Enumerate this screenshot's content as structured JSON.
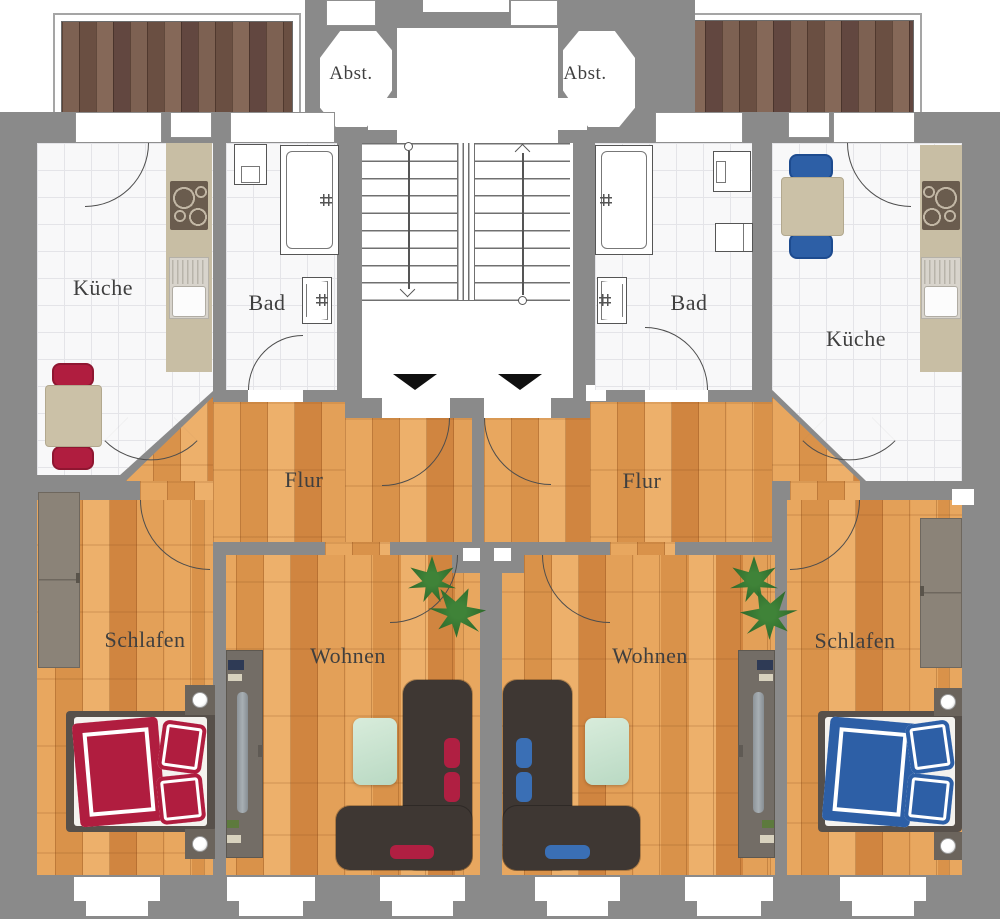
{
  "floorplan": {
    "type": "apartment-floor-plan",
    "language": "de",
    "labels": {
      "storage_left": "Abst.",
      "storage_right": "Abst.",
      "kitchen_left": "Küche",
      "bath_left": "Bad",
      "bath_right": "Bad",
      "kitchen_right": "Küche",
      "hall_left": "Flur",
      "hall_right": "Flur",
      "bedroom_left": "Schlafen",
      "living_left": "Wohnen",
      "living_right": "Wohnen",
      "bedroom_right": "Schlafen"
    },
    "colors": {
      "wall": "#8a8a8a",
      "tile_floor": "#f8f8f9",
      "tile_grout": "#e4e4e8",
      "wood_floor": "#dd9a55",
      "balcony_deck": "#75584a",
      "accent_left_red": "#b01d3f",
      "accent_right_blue": "#2d5fa6",
      "sofa": "#3e3733",
      "rug": "#cde4d0",
      "plant": "#2f6b2c",
      "furniture_beige": "#cbc1a7",
      "outline": "#4d4d4d",
      "label_text": "#3f3f3f"
    },
    "stairwell": {
      "flights": 2,
      "direction_markers": [
        "down-arrow",
        "up-arrow"
      ],
      "apartment_entrance_markers": 2
    },
    "fixtures": {
      "left_apartment": [
        "balcony-deck",
        "kitchen-counter",
        "stove",
        "kitchen-sink",
        "dining-table",
        "two-chairs",
        "washing-machine",
        "bathtub",
        "wash-basin",
        "wardrobe",
        "double-bed",
        "two-nightstands",
        "tv-lowboard",
        "corner-sofa",
        "rug",
        "plant"
      ],
      "right_apartment": [
        "balcony-deck",
        "kitchen-counter",
        "stove",
        "kitchen-sink",
        "dining-table",
        "two-chairs",
        "washing-machine",
        "bath-cabinet",
        "bathtub",
        "wash-basin",
        "wardrobe",
        "double-bed",
        "two-nightstands",
        "tv-lowboard",
        "corner-sofa",
        "rug",
        "plant"
      ]
    }
  }
}
